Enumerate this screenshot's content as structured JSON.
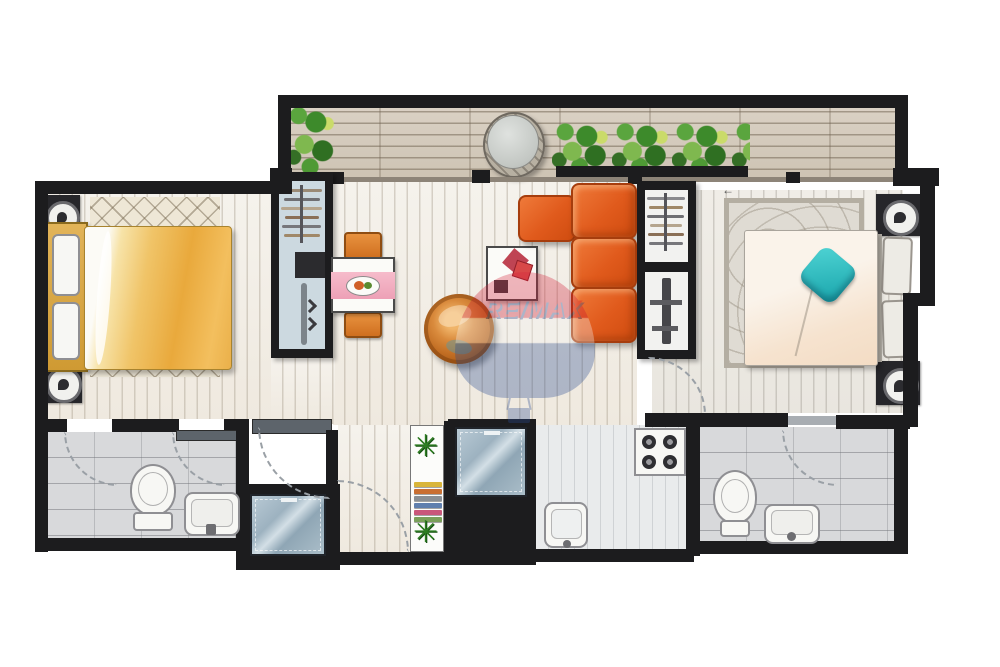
{
  "watermark": {
    "text": "RE/MAX"
  },
  "icons": {
    "plant": "✳",
    "slide_arrow": "←"
  },
  "colors": {
    "wall": "#1c1c1e",
    "sofa_orange": "#e05a1c",
    "chair_orange": "#dd7b2a",
    "duvet_yellow": "#edb045",
    "runner_pink": "#f3aec0",
    "accent_teal": "#2bbfc2",
    "plant_green": "#3f8a2e",
    "glass_blue": "#a3bac7",
    "deck_wood": "#d3c9ba",
    "tile_gray": "#d8d9db",
    "balloon_red": "#c8102e",
    "balloon_blue": "#1a3f94"
  }
}
